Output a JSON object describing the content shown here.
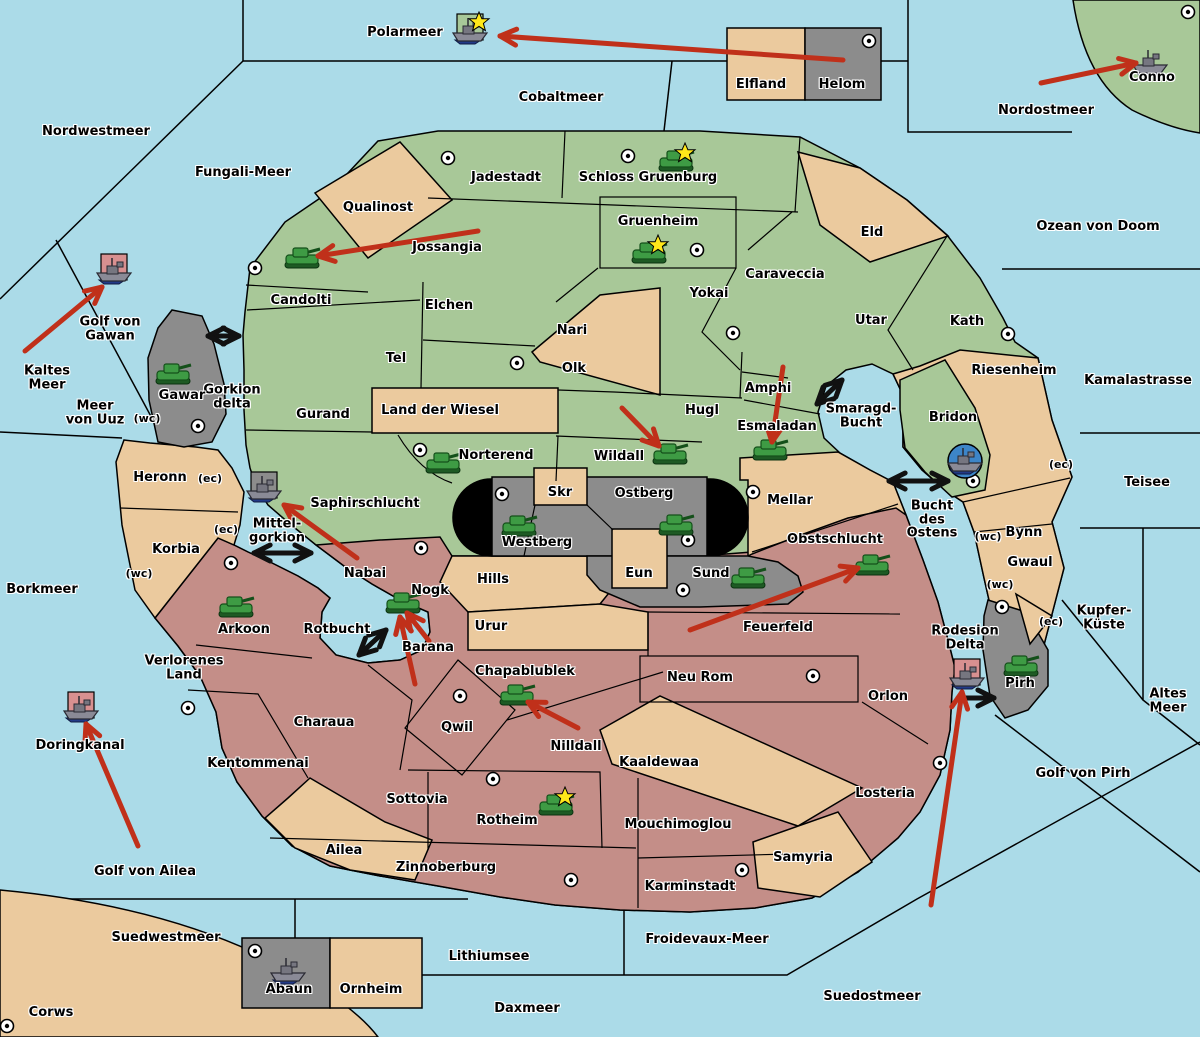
{
  "map": {
    "colors": {
      "sea": "#ABDBE8",
      "empire_green": "#A8C898",
      "neutral_tan": "#EBCA9E",
      "empire_red": "#C48E88",
      "gray_zone": "#8C8C8C",
      "black_zone": "#000000",
      "move_arrow": "#C0301A",
      "strait_arrow": "#111111",
      "pad_pink": "#D89090",
      "pad_green": "#A8C898",
      "pad_gray": "#8C8C8C",
      "pad_blue_circle": "#3D85C8",
      "star": "#FFE81A"
    },
    "sea_zones": [
      {
        "name": "Polarmeer",
        "x": 405,
        "y": 33
      },
      {
        "name": "Nordwestmeer",
        "x": 96,
        "y": 132
      },
      {
        "name": "Cobaltmeer",
        "x": 561,
        "y": 98
      },
      {
        "name": "Nordostmeer",
        "x": 1046,
        "y": 111
      },
      {
        "name": "Fungali-Meer",
        "x": 243,
        "y": 173
      },
      {
        "name": "Ozean von Doom",
        "x": 1098,
        "y": 227
      },
      {
        "name": "Kamalastrasse",
        "x": 1138,
        "y": 381
      },
      {
        "name": "Kaltes\nMeer",
        "x": 47,
        "y": 378
      },
      {
        "name": "Meer\nvon Uuz",
        "x": 95,
        "y": 413
      },
      {
        "name": "Golf von\nGawan",
        "x": 110,
        "y": 329
      },
      {
        "name": "Gorkion\ndelta",
        "x": 232,
        "y": 397
      },
      {
        "name": "Smaragd-\nBucht",
        "x": 861,
        "y": 416
      },
      {
        "name": "Bucht\ndes\nOstens",
        "x": 932,
        "y": 520
      },
      {
        "name": "Teisee",
        "x": 1147,
        "y": 483
      },
      {
        "name": "Borkmeer",
        "x": 42,
        "y": 590
      },
      {
        "name": "Mittel-\ngorkion",
        "x": 277,
        "y": 531
      },
      {
        "name": "Rotbucht",
        "x": 337,
        "y": 630
      },
      {
        "name": "Kupfer-\nKüste",
        "x": 1104,
        "y": 618
      },
      {
        "name": "Altes\nMeer",
        "x": 1168,
        "y": 701
      },
      {
        "name": "Golf von Pirh",
        "x": 1083,
        "y": 774
      },
      {
        "name": "Doringkanal",
        "x": 80,
        "y": 746
      },
      {
        "name": "Golf von Ailea",
        "x": 145,
        "y": 872
      },
      {
        "name": "Suedwestmeer",
        "x": 166,
        "y": 938
      },
      {
        "name": "Lithiumsee",
        "x": 489,
        "y": 957
      },
      {
        "name": "Daxmeer",
        "x": 527,
        "y": 1009
      },
      {
        "name": "Froidevaux-Meer",
        "x": 707,
        "y": 940
      },
      {
        "name": "Suedostmeer",
        "x": 872,
        "y": 997
      },
      {
        "name": "Rodesion\nDelta",
        "x": 965,
        "y": 638
      }
    ],
    "regions": [
      {
        "name": "Jadestadt",
        "x": 506,
        "y": 178,
        "empire": "green"
      },
      {
        "name": "Schloss Gruenburg",
        "x": 648,
        "y": 178,
        "empire": "green"
      },
      {
        "name": "Qualinost",
        "x": 378,
        "y": 208,
        "empire": "tan"
      },
      {
        "name": "Jossangia",
        "x": 447,
        "y": 248,
        "empire": "green"
      },
      {
        "name": "Gruenheim",
        "x": 658,
        "y": 222,
        "empire": "green"
      },
      {
        "name": "Eld",
        "x": 872,
        "y": 233,
        "empire": "tan"
      },
      {
        "name": "Caraveccia",
        "x": 785,
        "y": 275,
        "empire": "green"
      },
      {
        "name": "Yokai",
        "x": 709,
        "y": 294,
        "empire": "green"
      },
      {
        "name": "Candolti",
        "x": 301,
        "y": 301,
        "empire": "green"
      },
      {
        "name": "Elchen",
        "x": 449,
        "y": 306,
        "empire": "green"
      },
      {
        "name": "Nari",
        "x": 572,
        "y": 331,
        "empire": "tan"
      },
      {
        "name": "Utar",
        "x": 871,
        "y": 321,
        "empire": "green"
      },
      {
        "name": "Kath",
        "x": 967,
        "y": 322,
        "empire": "green"
      },
      {
        "name": "Tel",
        "x": 396,
        "y": 359,
        "empire": "green"
      },
      {
        "name": "Olk",
        "x": 574,
        "y": 369,
        "empire": "tan"
      },
      {
        "name": "Riesenheim",
        "x": 1014,
        "y": 371,
        "empire": "tan"
      },
      {
        "name": "Gawar",
        "x": 182,
        "y": 396,
        "empire": "gray"
      },
      {
        "name": "Gurand",
        "x": 323,
        "y": 415,
        "empire": "green"
      },
      {
        "name": "Land der Wiesel",
        "x": 440,
        "y": 411,
        "empire": "tan"
      },
      {
        "name": "Hugl",
        "x": 702,
        "y": 411,
        "empire": "green"
      },
      {
        "name": "Amphi",
        "x": 768,
        "y": 389,
        "empire": "green"
      },
      {
        "name": "Esmaladan",
        "x": 777,
        "y": 427,
        "empire": "green"
      },
      {
        "name": "Bridon",
        "x": 953,
        "y": 418,
        "empire": "green"
      },
      {
        "name": "Conno",
        "x": 1152,
        "y": 78,
        "empire": "green"
      },
      {
        "name": "Elfland",
        "x": 761,
        "y": 85,
        "empire": "tan"
      },
      {
        "name": "Helom",
        "x": 842,
        "y": 85,
        "empire": "gray"
      },
      {
        "name": "Norterend",
        "x": 496,
        "y": 456,
        "empire": "green"
      },
      {
        "name": "Wildall",
        "x": 619,
        "y": 457,
        "empire": "green"
      },
      {
        "name": "Mellar",
        "x": 790,
        "y": 501,
        "empire": "tan"
      },
      {
        "name": "Saphirschlucht",
        "x": 365,
        "y": 504,
        "empire": "green"
      },
      {
        "name": "Heronn",
        "x": 160,
        "y": 478,
        "empire": "tan"
      },
      {
        "name": "Korbia",
        "x": 176,
        "y": 550,
        "empire": "tan"
      },
      {
        "name": "Skr",
        "x": 560,
        "y": 493,
        "empire": "tan"
      },
      {
        "name": "Ostberg",
        "x": 644,
        "y": 494,
        "empire": "gray"
      },
      {
        "name": "Westberg",
        "x": 537,
        "y": 543,
        "empire": "gray"
      },
      {
        "name": "Eun",
        "x": 639,
        "y": 574,
        "empire": "tan"
      },
      {
        "name": "Sund",
        "x": 711,
        "y": 574,
        "empire": "gray"
      },
      {
        "name": "Obstschlucht",
        "x": 835,
        "y": 540,
        "empire": "red"
      },
      {
        "name": "Bynn",
        "x": 1024,
        "y": 533,
        "empire": "tan"
      },
      {
        "name": "Gwaul",
        "x": 1030,
        "y": 563,
        "empire": "tan"
      },
      {
        "name": "Nabai",
        "x": 365,
        "y": 574,
        "empire": "red"
      },
      {
        "name": "Nogk",
        "x": 430,
        "y": 591,
        "empire": "red"
      },
      {
        "name": "Hills",
        "x": 493,
        "y": 580,
        "empire": "tan"
      },
      {
        "name": "Urur",
        "x": 491,
        "y": 627,
        "empire": "tan"
      },
      {
        "name": "Arkoon",
        "x": 244,
        "y": 630,
        "empire": "red"
      },
      {
        "name": "Barana",
        "x": 428,
        "y": 648,
        "empire": "red"
      },
      {
        "name": "Feuerfeld",
        "x": 778,
        "y": 628,
        "empire": "red"
      },
      {
        "name": "Verlorenes\nLand",
        "x": 184,
        "y": 668,
        "empire": "red"
      },
      {
        "name": "Chapablublek",
        "x": 525,
        "y": 672,
        "empire": "red"
      },
      {
        "name": "Neu Rom",
        "x": 700,
        "y": 678,
        "empire": "red"
      },
      {
        "name": "Orlon",
        "x": 888,
        "y": 697,
        "empire": "red"
      },
      {
        "name": "Qwil",
        "x": 457,
        "y": 728,
        "empire": "red"
      },
      {
        "name": "Charaua",
        "x": 324,
        "y": 723,
        "empire": "red"
      },
      {
        "name": "Nilldall",
        "x": 576,
        "y": 747,
        "empire": "red"
      },
      {
        "name": "Kaaldewaa",
        "x": 659,
        "y": 763,
        "empire": "tan"
      },
      {
        "name": "Kentommenai",
        "x": 258,
        "y": 764,
        "empire": "red"
      },
      {
        "name": "Pirh",
        "x": 1020,
        "y": 684,
        "empire": "gray"
      },
      {
        "name": "Sottovia",
        "x": 417,
        "y": 800,
        "empire": "red"
      },
      {
        "name": "Rotheim",
        "x": 507,
        "y": 821,
        "empire": "red"
      },
      {
        "name": "Mouchimoglou",
        "x": 678,
        "y": 825,
        "empire": "red"
      },
      {
        "name": "Losteria",
        "x": 885,
        "y": 794,
        "empire": "red"
      },
      {
        "name": "Ailea",
        "x": 344,
        "y": 851,
        "empire": "tan"
      },
      {
        "name": "Zinnoberburg",
        "x": 446,
        "y": 868,
        "empire": "red"
      },
      {
        "name": "Karminstadt",
        "x": 690,
        "y": 887,
        "empire": "red"
      },
      {
        "name": "Samyria",
        "x": 803,
        "y": 858,
        "empire": "tan"
      },
      {
        "name": "Corws",
        "x": 51,
        "y": 1013,
        "empire": "tan"
      },
      {
        "name": "Abaun",
        "x": 289,
        "y": 990,
        "empire": "gray"
      },
      {
        "name": "Ornheim",
        "x": 371,
        "y": 990,
        "empire": "tan"
      }
    ],
    "control_markers": [
      {
        "text": "(wc)",
        "x": 147,
        "y": 419
      },
      {
        "text": "(ec)",
        "x": 210,
        "y": 479
      },
      {
        "text": "(ec)",
        "x": 226,
        "y": 530
      },
      {
        "text": "(wc)",
        "x": 139,
        "y": 574
      },
      {
        "text": "(ec)",
        "x": 1061,
        "y": 465
      },
      {
        "text": "(wc)",
        "x": 988,
        "y": 537
      },
      {
        "text": "(wc)",
        "x": 1000,
        "y": 585
      },
      {
        "text": "(ec)",
        "x": 1051,
        "y": 622
      }
    ],
    "cities": [
      {
        "x": 869,
        "y": 41
      },
      {
        "x": 1188,
        "y": 12
      },
      {
        "x": 448,
        "y": 158
      },
      {
        "x": 628,
        "y": 156
      },
      {
        "x": 255,
        "y": 268
      },
      {
        "x": 697,
        "y": 250
      },
      {
        "x": 733,
        "y": 333
      },
      {
        "x": 1008,
        "y": 334
      },
      {
        "x": 198,
        "y": 426
      },
      {
        "x": 517,
        "y": 363
      },
      {
        "x": 420,
        "y": 450
      },
      {
        "x": 421,
        "y": 548
      },
      {
        "x": 753,
        "y": 492
      },
      {
        "x": 502,
        "y": 494
      },
      {
        "x": 688,
        "y": 540
      },
      {
        "x": 683,
        "y": 590
      },
      {
        "x": 973,
        "y": 481
      },
      {
        "x": 231,
        "y": 563
      },
      {
        "x": 460,
        "y": 696
      },
      {
        "x": 188,
        "y": 708
      },
      {
        "x": 813,
        "y": 676
      },
      {
        "x": 493,
        "y": 779
      },
      {
        "x": 571,
        "y": 880
      },
      {
        "x": 742,
        "y": 870
      },
      {
        "x": 940,
        "y": 763
      },
      {
        "x": 255,
        "y": 951
      },
      {
        "x": 7,
        "y": 1026
      },
      {
        "x": 1002,
        "y": 607
      }
    ],
    "units": [
      {
        "type": "tank",
        "x": 676,
        "y": 162,
        "star": true
      },
      {
        "type": "tank",
        "x": 649,
        "y": 254,
        "star": true
      },
      {
        "type": "tank",
        "x": 302,
        "y": 259,
        "star": false
      },
      {
        "type": "tank",
        "x": 173,
        "y": 375,
        "star": false
      },
      {
        "type": "tank",
        "x": 443,
        "y": 464,
        "star": false
      },
      {
        "type": "tank",
        "x": 670,
        "y": 455,
        "star": false
      },
      {
        "type": "tank",
        "x": 770,
        "y": 451,
        "star": false
      },
      {
        "type": "tank",
        "x": 519,
        "y": 527,
        "star": false
      },
      {
        "type": "tank",
        "x": 676,
        "y": 526,
        "star": false
      },
      {
        "type": "tank",
        "x": 748,
        "y": 579,
        "star": false
      },
      {
        "type": "tank",
        "x": 872,
        "y": 566,
        "star": false
      },
      {
        "type": "tank",
        "x": 236,
        "y": 608,
        "star": false
      },
      {
        "type": "tank",
        "x": 403,
        "y": 604,
        "star": false
      },
      {
        "type": "tank",
        "x": 517,
        "y": 696,
        "star": false
      },
      {
        "type": "tank",
        "x": 556,
        "y": 806,
        "star": true
      },
      {
        "type": "tank",
        "x": 1021,
        "y": 667,
        "star": false
      },
      {
        "type": "ship",
        "x": 470,
        "y": 31,
        "star": true,
        "pad": "green"
      },
      {
        "type": "ship",
        "x": 1150,
        "y": 63,
        "star": false
      },
      {
        "type": "ship",
        "x": 114,
        "y": 271,
        "star": false,
        "pad": "pink"
      },
      {
        "type": "ship",
        "x": 264,
        "y": 489,
        "star": false,
        "pad": "gray"
      },
      {
        "type": "ship",
        "x": 81,
        "y": 709,
        "star": false,
        "pad": "pink"
      },
      {
        "type": "ship",
        "x": 288,
        "y": 971,
        "star": false
      },
      {
        "type": "ship",
        "x": 965,
        "y": 461,
        "star": false,
        "pad": "circle"
      },
      {
        "type": "ship",
        "x": 967,
        "y": 676,
        "star": false,
        "pad": "pink"
      }
    ],
    "moves_red": [
      {
        "x1": 843,
        "y1": 60,
        "x2": 500,
        "y2": 36
      },
      {
        "x1": 1041,
        "y1": 83,
        "x2": 1136,
        "y2": 63
      },
      {
        "x1": 478,
        "y1": 231,
        "x2": 318,
        "y2": 256
      },
      {
        "x1": 25,
        "y1": 351,
        "x2": 102,
        "y2": 287
      },
      {
        "x1": 622,
        "y1": 408,
        "x2": 659,
        "y2": 446
      },
      {
        "x1": 783,
        "y1": 367,
        "x2": 772,
        "y2": 442
      },
      {
        "x1": 690,
        "y1": 630,
        "x2": 858,
        "y2": 568
      },
      {
        "x1": 357,
        "y1": 558,
        "x2": 284,
        "y2": 505
      },
      {
        "x1": 429,
        "y1": 641,
        "x2": 407,
        "y2": 613
      },
      {
        "x1": 415,
        "y1": 684,
        "x2": 400,
        "y2": 617
      },
      {
        "x1": 578,
        "y1": 728,
        "x2": 528,
        "y2": 702
      },
      {
        "x1": 138,
        "y1": 846,
        "x2": 86,
        "y2": 724
      },
      {
        "x1": 931,
        "y1": 905,
        "x2": 962,
        "y2": 692
      }
    ],
    "straits_black": [
      {
        "x1": 208,
        "y1": 336,
        "x2": 239,
        "y2": 336,
        "double": true
      },
      {
        "x1": 817,
        "y1": 404,
        "x2": 842,
        "y2": 380,
        "double": true
      },
      {
        "x1": 254,
        "y1": 553,
        "x2": 311,
        "y2": 553,
        "double": true
      },
      {
        "x1": 889,
        "y1": 481,
        "x2": 948,
        "y2": 481,
        "double": true
      },
      {
        "x1": 359,
        "y1": 655,
        "x2": 386,
        "y2": 630,
        "double": true
      },
      {
        "x1": 958,
        "y1": 698,
        "x2": 994,
        "y2": 698,
        "double": false
      }
    ]
  }
}
